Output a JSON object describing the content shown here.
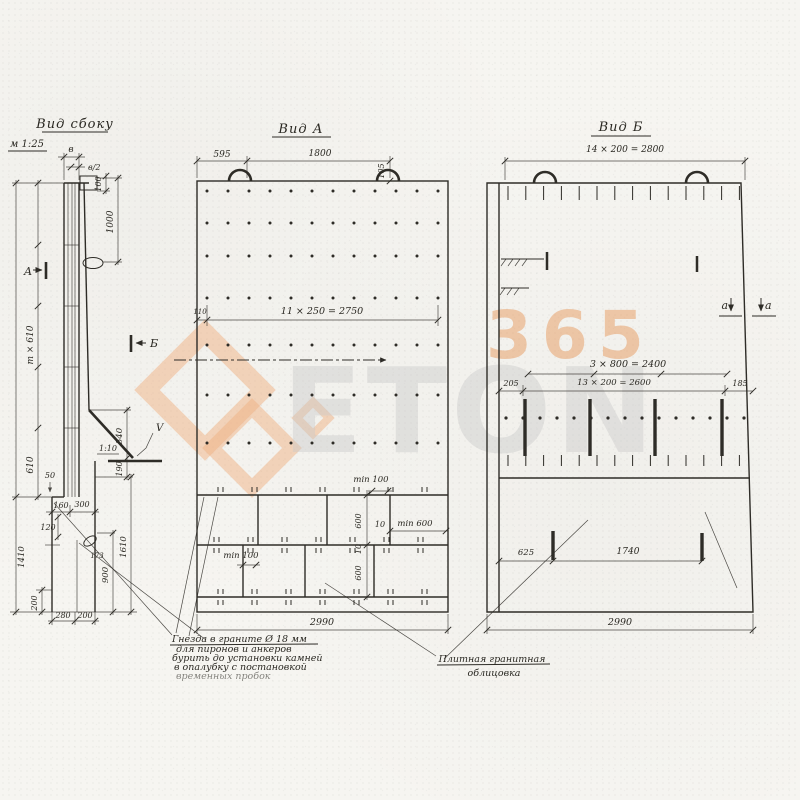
{
  "side_view": {
    "title": "Вид сбоку",
    "scale": "м 1:25",
    "section_a": "А",
    "section_b": "Б",
    "mark_v": "V",
    "slope": "1:10",
    "dim_b": "в",
    "dim_b2": "в/2",
    "dim_100": "100",
    "dim_1000": "1000",
    "dim_mx610": "m × 610",
    "dim_610": "610",
    "dim_50": "50",
    "dim_160": "160",
    "dim_300": "300",
    "dim_120": "120",
    "dim_540": "540",
    "dim_190": "190",
    "dim_1610": "1610",
    "dim_900": "900",
    "dim_1410": "1410",
    "dim_200a": "200",
    "dim_280": "280",
    "dim_200b": "200",
    "dim_173": "173"
  },
  "view_a": {
    "title": "Вид А",
    "dim_595": "595",
    "dim_1800": "1800",
    "dim_105": "105",
    "dim_110": "110",
    "dim_spacing": "11 × 250 = 2750",
    "dim_min100_r": "min 100",
    "dim_600_1": "600",
    "dim_10_rot": "10",
    "dim_600_2": "600",
    "dim_10_h": "10",
    "dim_min600": "min 600",
    "dim_min100_l": "min 100",
    "dim_2990": "2990"
  },
  "view_b": {
    "title": "Вид Б",
    "dim_top": "14 × 200 = 2800",
    "dim_2400": "3 × 800 = 2400",
    "dim_205": "205",
    "dim_2600": "13 × 200 = 2600",
    "dim_185": "185",
    "dim_625": "625",
    "dim_1740": "1740",
    "dim_2990": "2990",
    "section_a1": "a",
    "section_a2": "a"
  },
  "notes": {
    "note1_line1": "Гнезда в граните  Ø 18 мм",
    "note1_line2": "для пиронов и анкеров",
    "note1_line3": "бурить до установки камней",
    "note1_line4": "в опалубку с постановкой",
    "note1_line5": "временных пробок",
    "note2_line1": "Плитная гранитная",
    "note2_line2": "облицовка"
  },
  "watermark": {
    "number": "365",
    "word": "ETON",
    "orange": "#efb183",
    "gray": "#c9c9c9"
  }
}
